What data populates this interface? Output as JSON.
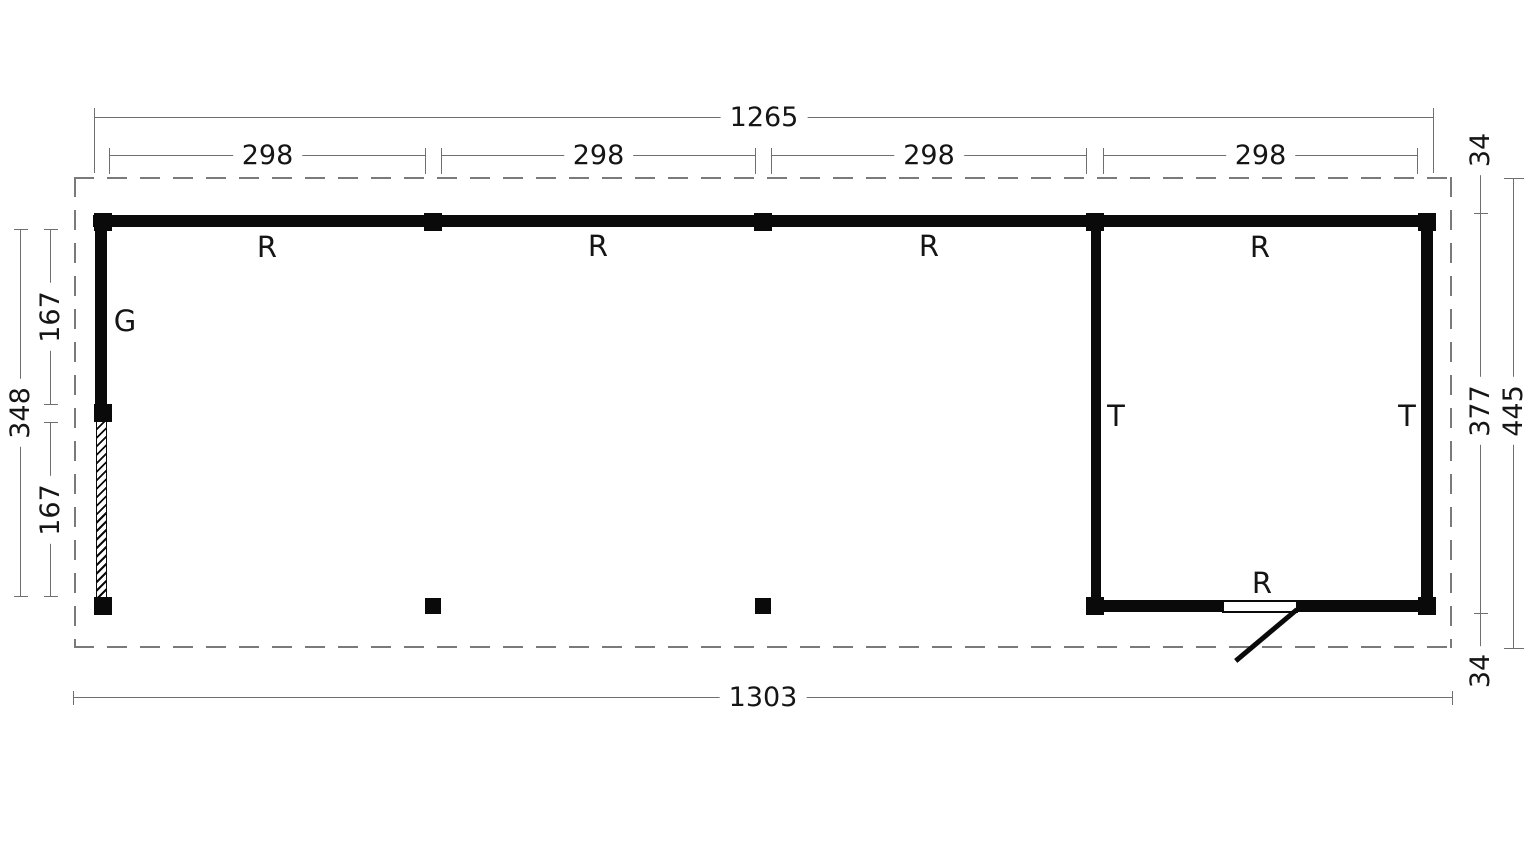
{
  "dims": {
    "top_total": "1265",
    "top_segments": [
      "298",
      "298",
      "298",
      "298"
    ],
    "bottom_total": "1303",
    "left_total": "348",
    "left_upper": "167",
    "left_lower": "167",
    "right_top_overhang": "34",
    "right_inner": "377",
    "right_total": "445",
    "right_bottom_overhang": "34"
  },
  "labels": {
    "r": [
      "R",
      "R",
      "R",
      "R"
    ],
    "g": "G",
    "t": [
      "T",
      "T"
    ],
    "door_r": "R"
  },
  "colors": {
    "wall": "#0a0a0a",
    "dim": "#6f6f6f",
    "dashed": "#7a7a7a",
    "text": "#151515"
  }
}
